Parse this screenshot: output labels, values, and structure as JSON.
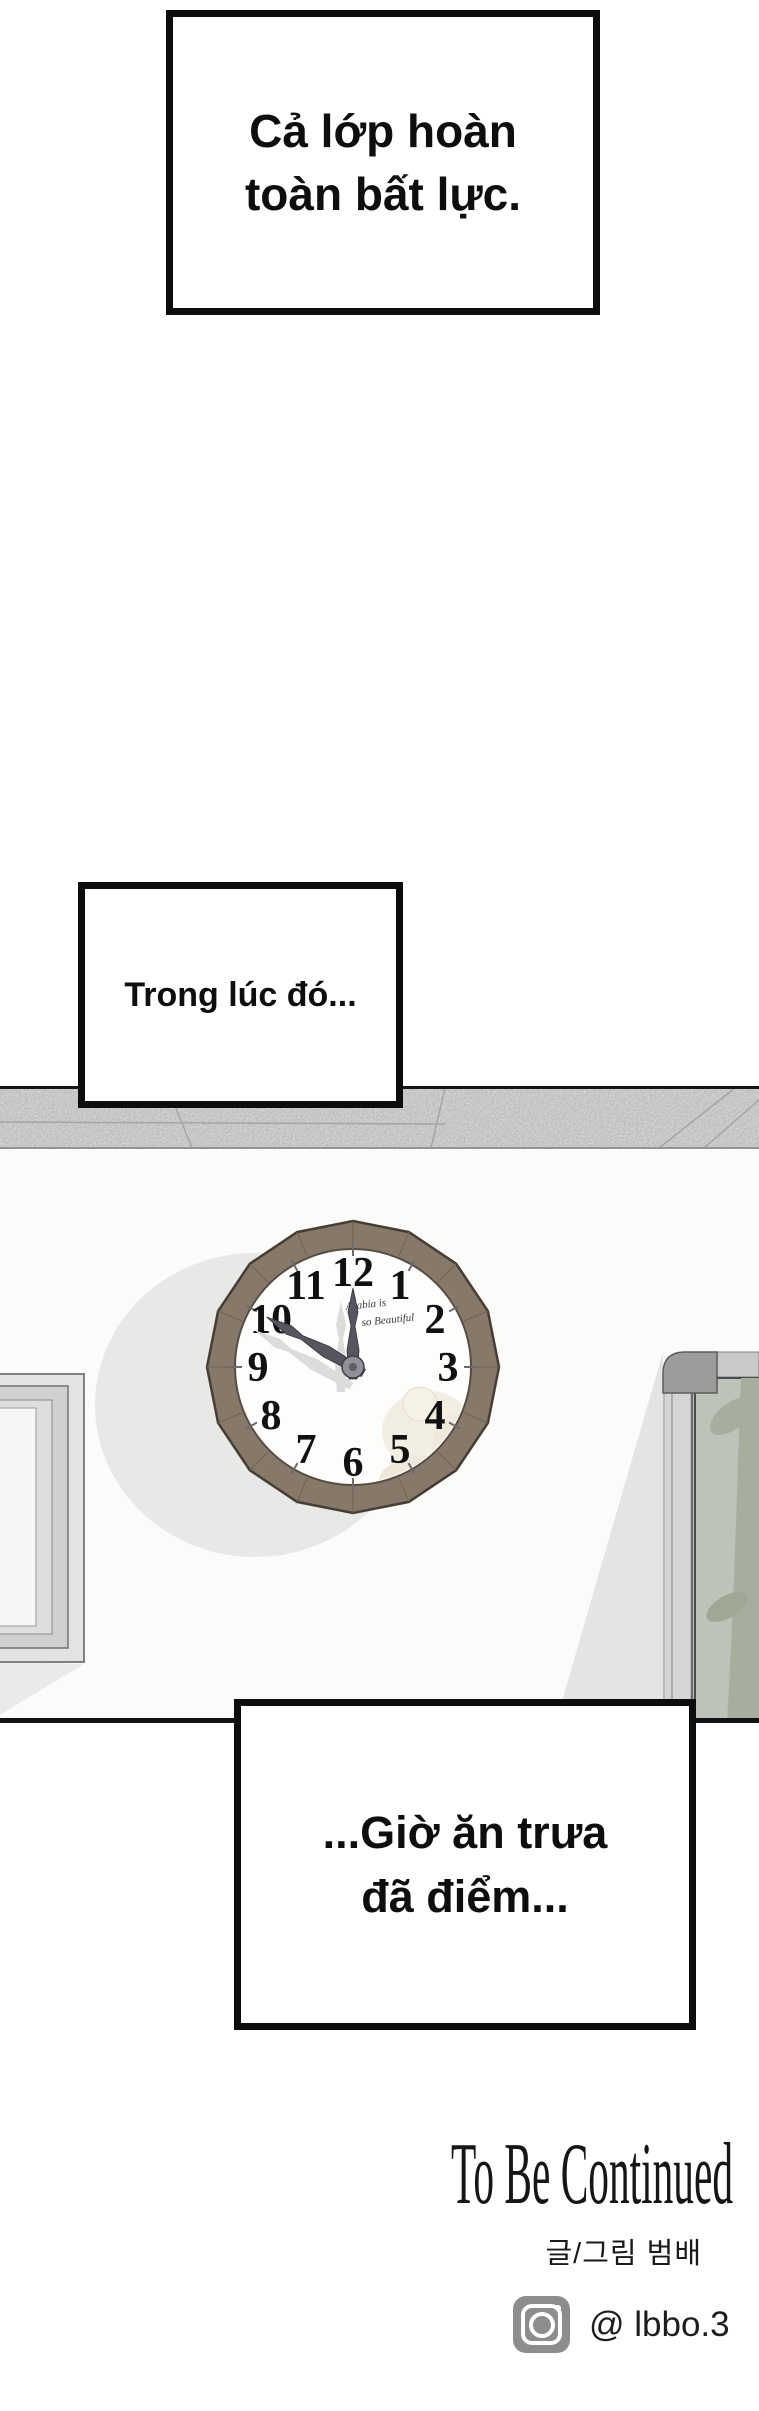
{
  "panels": {
    "caption1": {
      "line1": "Cả lớp hoàn",
      "line2": "toàn bất lực."
    },
    "caption2": {
      "text": "Trong lúc đó..."
    },
    "caption3": {
      "line1": "...Giờ ăn trưa",
      "line2": "đã điểm..."
    }
  },
  "scene": {
    "wall_color": "#fbfbf9",
    "ceiling_strip_color": "#dbdbda",
    "door_glass_color": "#bdc3b8",
    "clock": {
      "time_shown": "11:50",
      "numerals": [
        "12",
        "1",
        "2",
        "3",
        "4",
        "5",
        "6",
        "7",
        "8",
        "9",
        "10",
        "11"
      ],
      "face_text_line1": "Arabia is",
      "face_text_line2": "so Beautiful",
      "frame_color": "#867969",
      "face_color": "#fdfdfc",
      "hand_color": "#565660"
    }
  },
  "footer": {
    "to_be_continued": "To Be Continued",
    "credit": "글/그림 범배",
    "instagram_handle": "@ lbbo.3",
    "instagram_icon": "instagram-icon",
    "instagram_icon_color": "#8d8d8d"
  }
}
